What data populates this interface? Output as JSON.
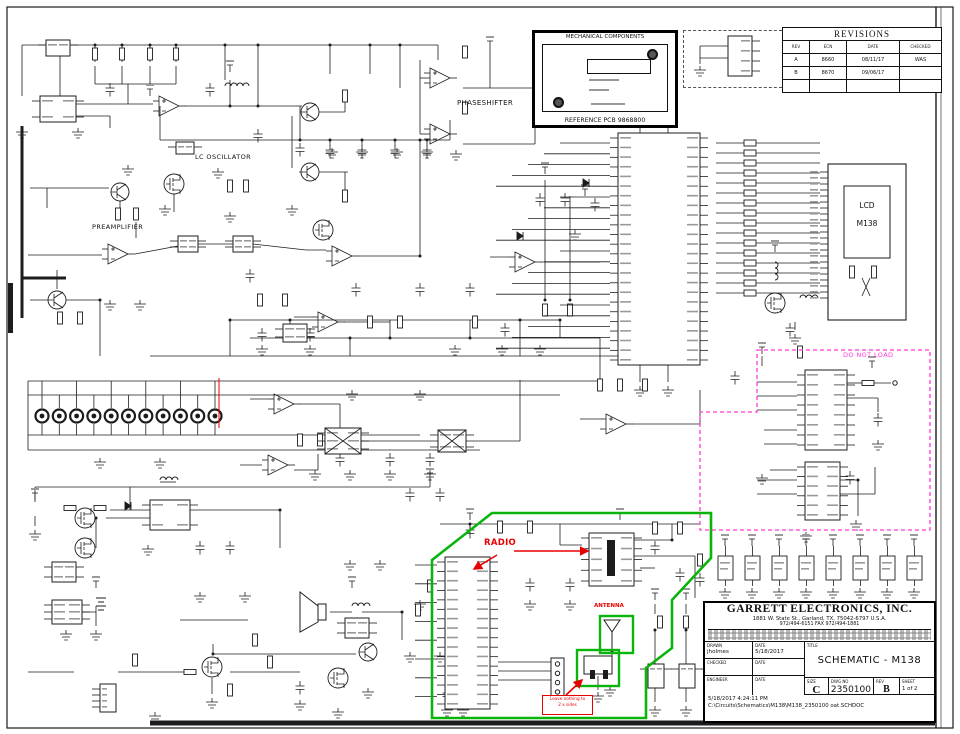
{
  "colors": {
    "line": "#1c1c1c",
    "green": "#0ab40a",
    "red": "#e80000",
    "magenta": "#ff3ad6"
  },
  "revisions": {
    "title": "REVISIONS",
    "columns": [
      "REV",
      "ECN",
      "DATE",
      "CHECKED"
    ],
    "rows": [
      {
        "rev": "A",
        "ecn": "8660",
        "date": "08/11/17",
        "checked": "WAS"
      },
      {
        "rev": "B",
        "ecn": "8670",
        "date": "09/06/17",
        "checked": ""
      }
    ]
  },
  "mechanical": {
    "title": "MECHANICAL COMPONENTS",
    "reference": "REFERENCE PCB 9868800"
  },
  "sections": {
    "phaseshifter": "PHASESHIFTER",
    "lc_oscillator": "LC OSCILLATOR",
    "preamplifier": "PREAMPLIFIER"
  },
  "lcd": {
    "line1": "LCD",
    "line2": "M138"
  },
  "annotations": {
    "do_not_load": "DO NOT LOAD",
    "radio": "RADIO",
    "antenna": "ANTENNA",
    "note_line1": "Leave nothing to",
    "note_line2": "2 x sides"
  },
  "title_block": {
    "company": "GARRETT ELECTRONICS, INC.",
    "address": "1881 W. State St., Garland, TX, 75042-6797 U.S.A.",
    "phone": "972/494-6151      FAX 972/494-1881",
    "labels": {
      "drawn": "DRAWN",
      "checked": "CHECKED",
      "engineer": "ENGINEER",
      "date": "DATE",
      "title": "TITLE",
      "size": "SIZE",
      "dwg": "DWG NO",
      "rev": "REV",
      "sheet": "SHEET"
    },
    "values": {
      "drawn_by": "jholmes",
      "drawn_date": "5/18/2017",
      "title": "SCHEMATIC - M138",
      "size": "C",
      "dwg_no": "2350100",
      "rev": "B",
      "sheet": "1 of 2",
      "printed": "5/18/2017    4:24:11 PM",
      "file_path": "C:\\Circuits\\Schematics\\M138\\M138_2350100 oat.SCHDOC"
    }
  }
}
